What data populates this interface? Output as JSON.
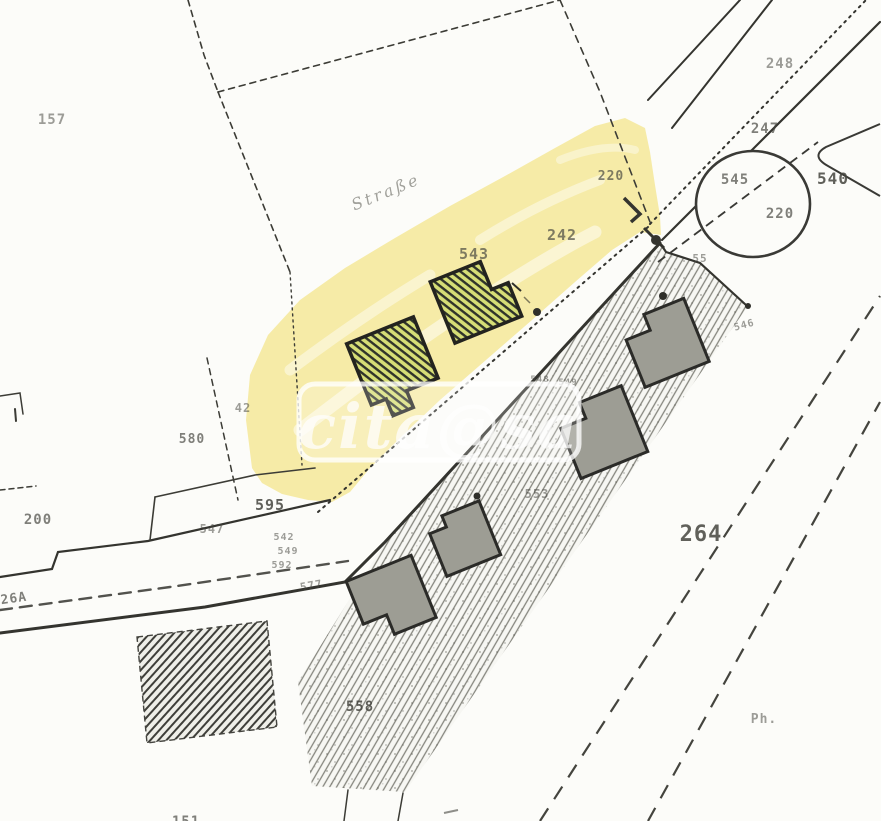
{
  "map": {
    "type": "cadastral-plan-scan",
    "street_label": "Straße",
    "watermark_text": "cita@sa",
    "parcel_labels": {
      "n157": "157",
      "n248": "248",
      "n247": "247",
      "n545": "545",
      "n220_circle": "220",
      "n540": "540",
      "n220": "220",
      "n242": "242",
      "n543": "543",
      "n55": "55",
      "n546": "546",
      "n548": "548",
      "n549": "549",
      "n42": "42",
      "n580": "580",
      "n595": "595",
      "n547": "547",
      "n542s": "542",
      "n549s": "549",
      "n592s": "592",
      "n577": "577",
      "n126a": "126A",
      "n200": "200",
      "n553": "553",
      "n558": "558",
      "n264": "264",
      "nPh": "Ph.",
      "n151": "151"
    },
    "colors": {
      "paper": "#fcfcf9",
      "ink": "#34342f",
      "highlight_yellow": "#f5e9a0",
      "building_gray": "#9d9d94",
      "building_green_hatch": "#d6de76",
      "parcel_hatch": "#85857d"
    }
  }
}
